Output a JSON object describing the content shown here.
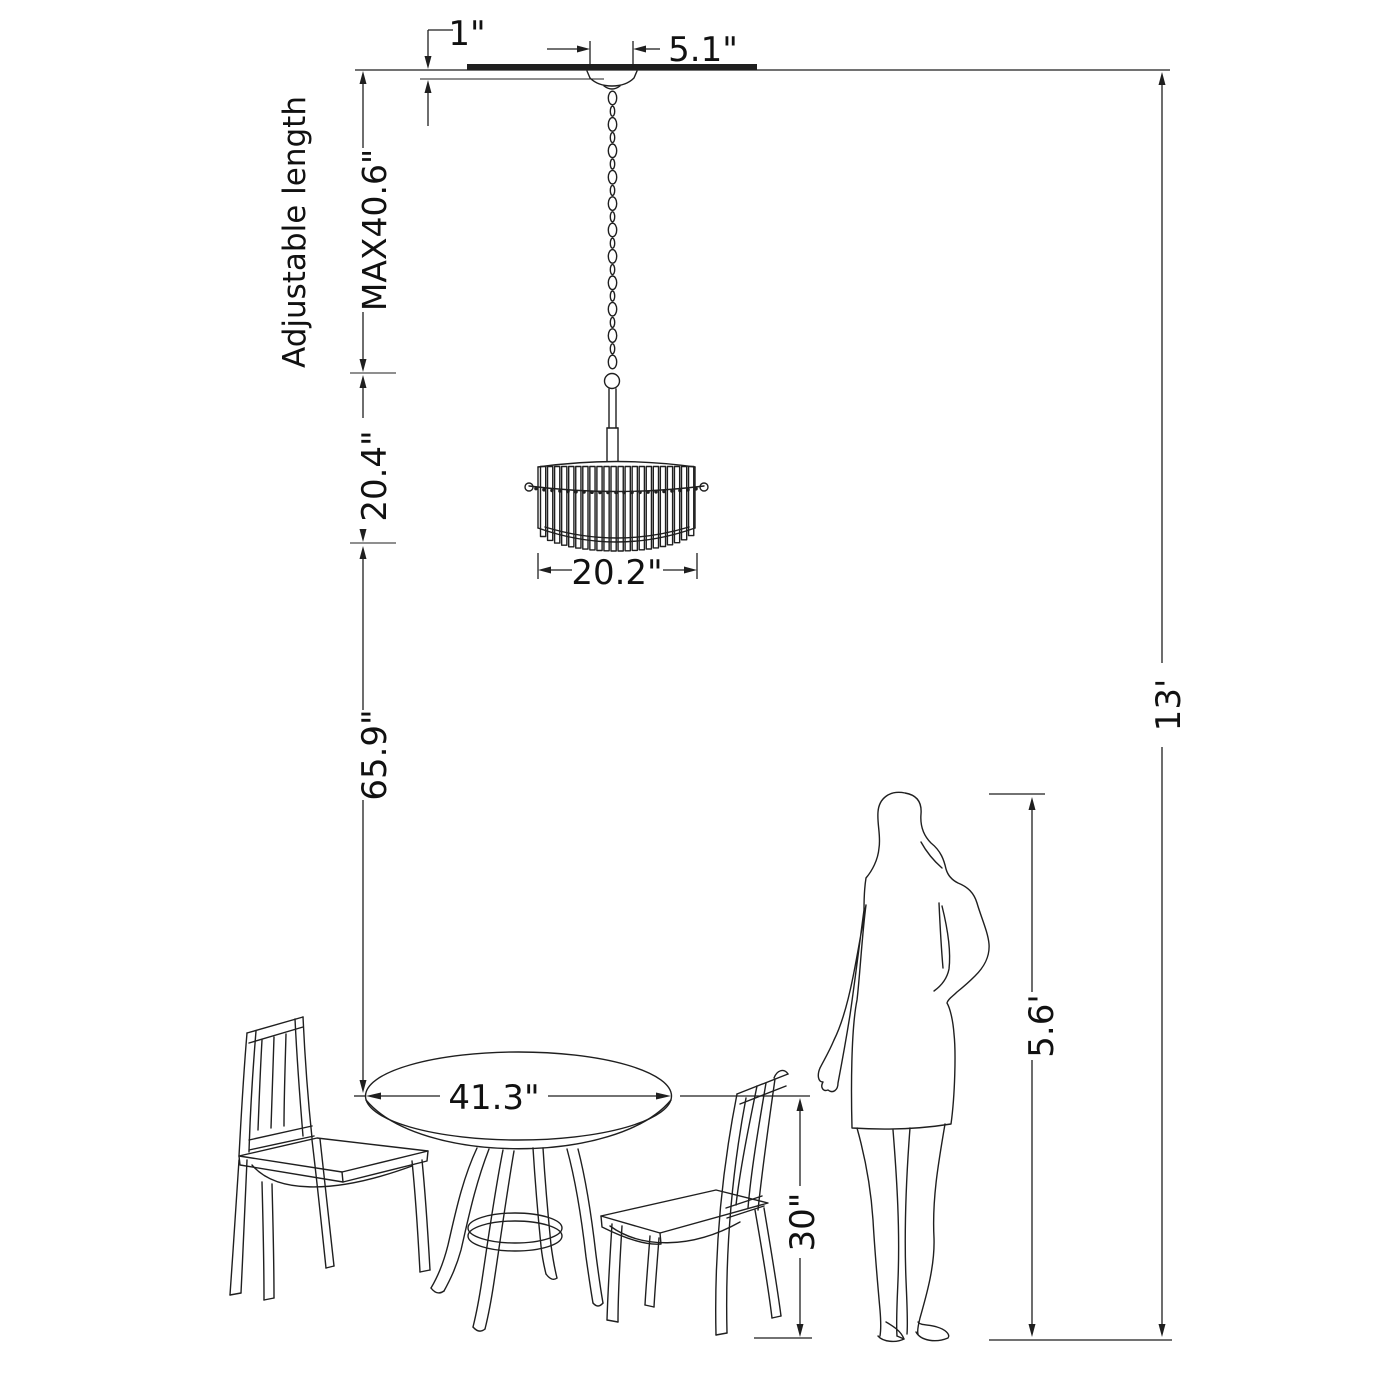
{
  "diagram": {
    "colors": {
      "background": "#ffffff",
      "line": "#1f1f1f",
      "text": "#111111"
    },
    "labels": {
      "canopy_height": "1\"",
      "canopy_diameter": "5.1\"",
      "adjustable": "Adjustable length",
      "max_length": "MAX40.6\"",
      "fixture_height": "20.4\"",
      "shade_diameter": "20.2\"",
      "clearance": "65.9\"",
      "table_diameter": "41.3\"",
      "table_height": "30\"",
      "person_height": "5.6'",
      "ceiling_height": "13'"
    }
  }
}
